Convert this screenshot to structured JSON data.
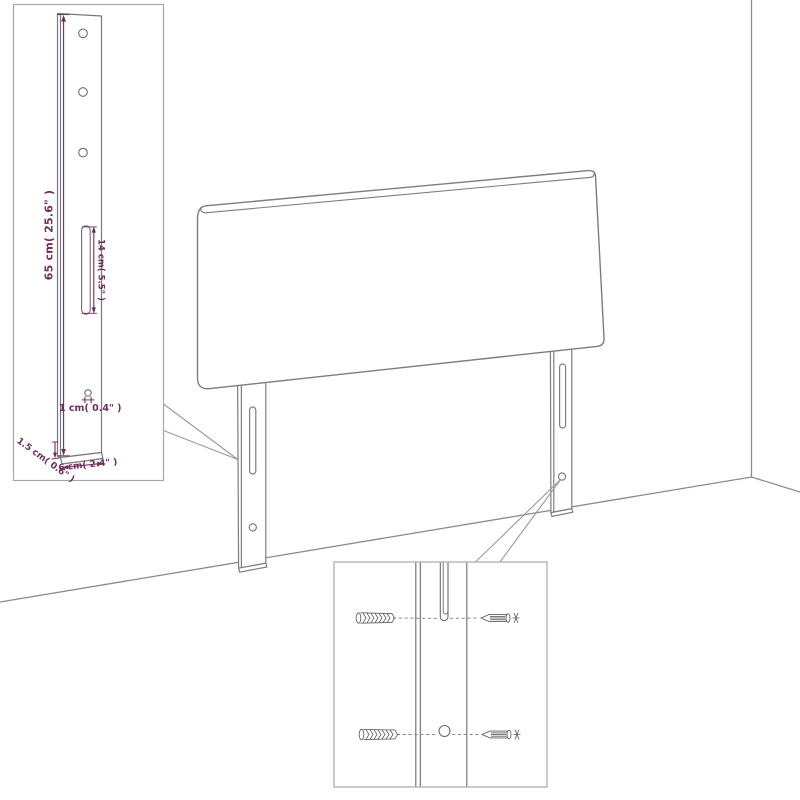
{
  "diagram": {
    "background": "#ffffff",
    "line_color": "#808080",
    "detail_box_border": "#a8a8a8",
    "dimension_color": "#6f2c5a",
    "dimensions": {
      "leg_height": "65 cm( 25.6\" )",
      "slot_length": "14 cm( 5.5\" )",
      "hole_diameter": "1 cm( 0.4\" )",
      "leg_depth": "1.5 cm( 0.6\" )",
      "leg_width": "6 cm( 2.4\" )"
    }
  }
}
